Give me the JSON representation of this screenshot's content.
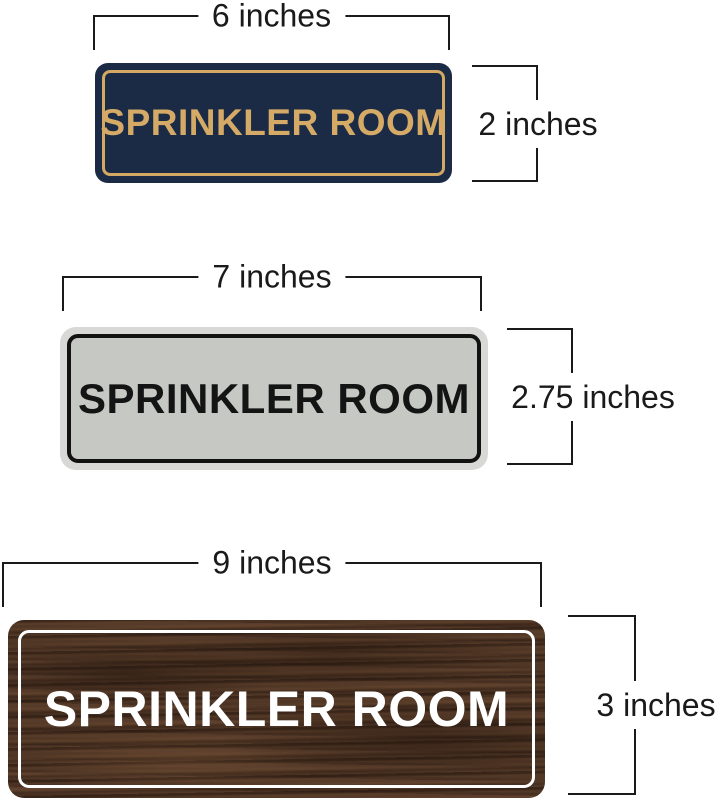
{
  "figure": {
    "background_color": "#ffffff",
    "dimension_line_color": "#1a1a1a",
    "signs": [
      {
        "name": "navy-gold-sprinkler-room-sign",
        "text": "SPRINKLER ROOM",
        "width_label": "6 inches",
        "height_label": "2 inches",
        "colors": {
          "face": "#1c2b45",
          "frame": "#d2a862",
          "text": "#d4aa66"
        }
      },
      {
        "name": "silver-black-sprinkler-room-sign",
        "text": "SPRINKLER ROOM",
        "width_label": "7 inches",
        "height_label": "2.75 inches",
        "colors": {
          "rim": "#d8d9d6",
          "face": "#c6c8c3",
          "frame": "#121212",
          "text": "#141414"
        }
      },
      {
        "name": "walnut-wood-sprinkler-room-sign",
        "text": "SPRINKLER ROOM",
        "width_label": "9 inches",
        "height_label": "3 inches",
        "colors": {
          "face": "#54392a",
          "frame": "#ffffff",
          "text": "#ffffff"
        }
      }
    ]
  }
}
